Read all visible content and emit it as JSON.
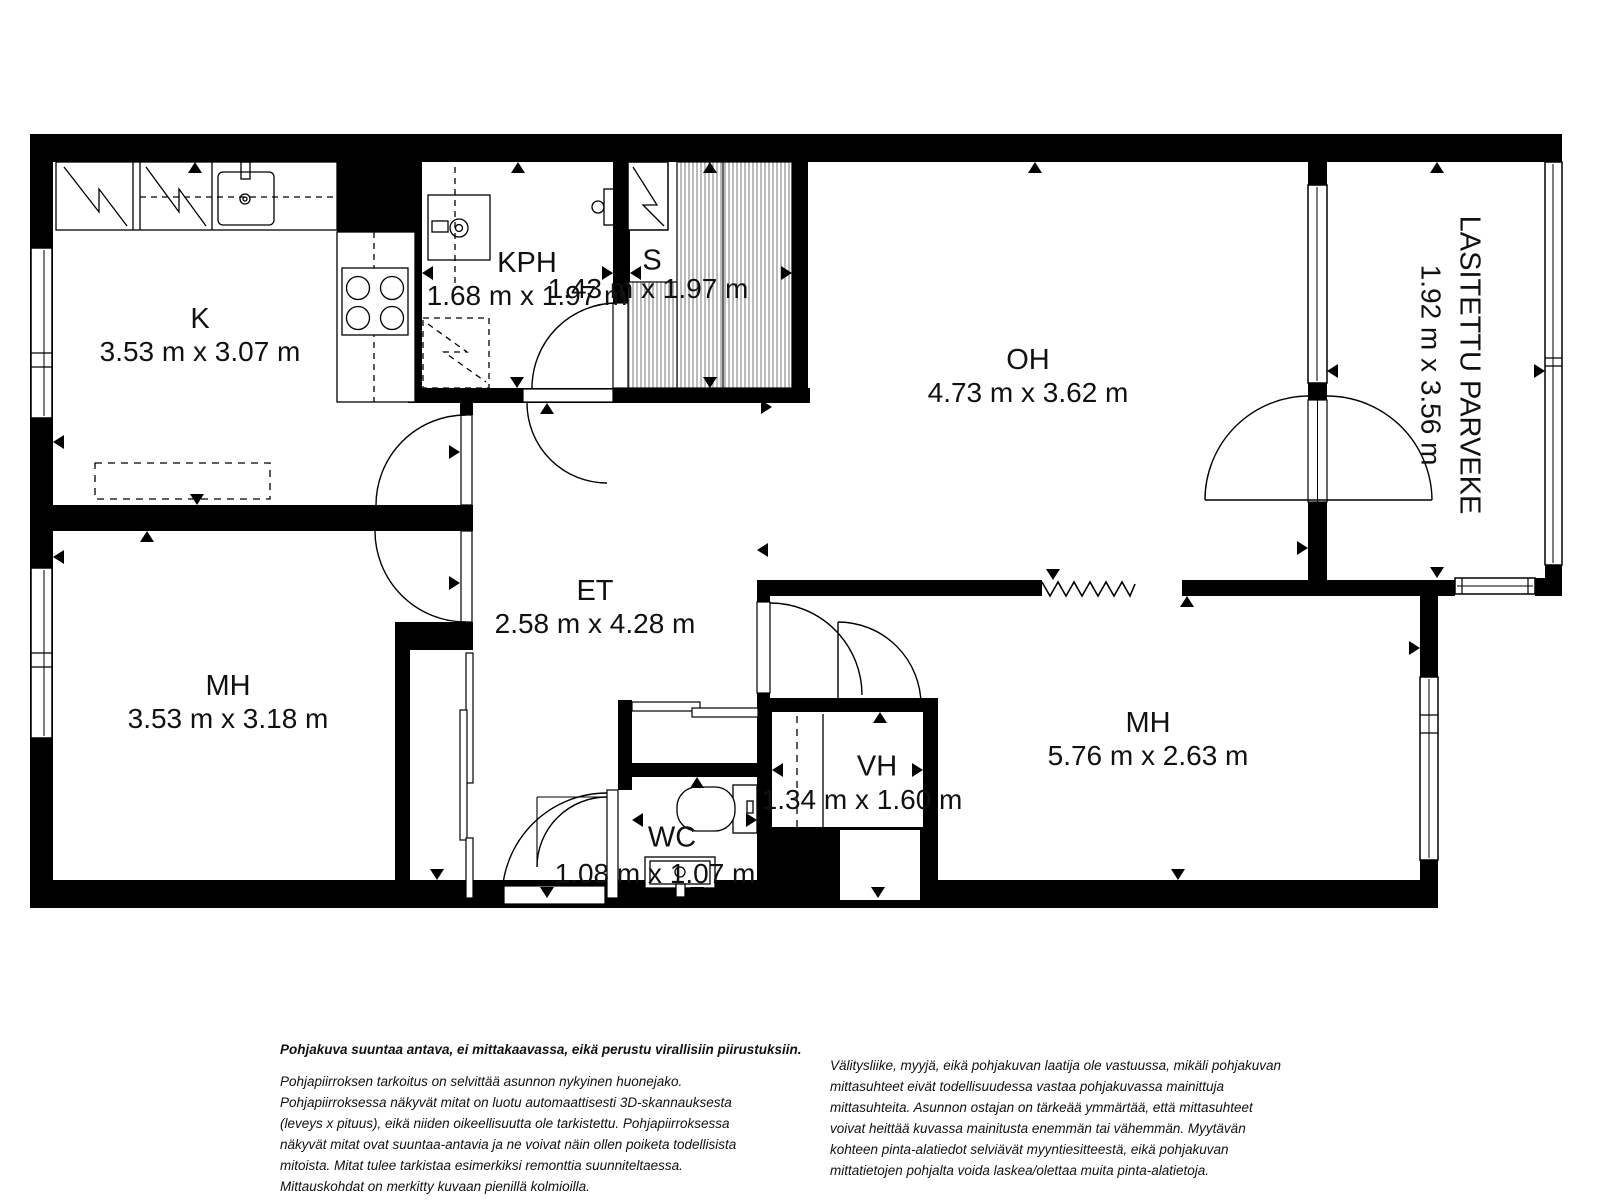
{
  "plan": {
    "rooms": [
      {
        "key": "k",
        "name": "K",
        "dims": "3.53 m x 3.07 m"
      },
      {
        "key": "kph",
        "name": "KPH",
        "dims": "1.68 m x 1.97 m"
      },
      {
        "key": "s",
        "name": "S",
        "dims": "1.43 m x 1.97 m"
      },
      {
        "key": "oh",
        "name": "OH",
        "dims": "4.73 m x 3.62 m"
      },
      {
        "key": "parveke",
        "name": "LASITETTU PARVEKE",
        "dims": "1.92 m x 3.56 m"
      },
      {
        "key": "mh1",
        "name": "MH",
        "dims": "3.53 m x 3.18 m"
      },
      {
        "key": "et",
        "name": "ET",
        "dims": "2.58 m x 4.28 m"
      },
      {
        "key": "vh",
        "name": "VH",
        "dims": "1.34 m x 1.60 m"
      },
      {
        "key": "wc",
        "name": "WC",
        "dims": "1.08 m x 1.07 m"
      },
      {
        "key": "mh2",
        "name": "MH",
        "dims": "5.76 m x 2.63 m"
      }
    ]
  },
  "footer": {
    "disclaimer_bold": "Pohjakuva suuntaa antava, ei mittakaavassa, eikä perustu virallisiin piirustuksiin.",
    "disclaimer_left": "Pohjapiirroksen tarkoitus on selvittää asunnon nykyinen huonejako. Pohjapiirroksessa näkyvät mitat on luotu automaattisesti 3D-skannauksesta (leveys x pituus), eikä niiden oikeellisuutta ole tarkistettu. Pohjapiirroksessa näkyvät mitat ovat suuntaa-antavia ja ne voivat näin ollen poiketa todellisista mitoista. Mitat tulee tarkistaa esimerkiksi remonttia suunniteltaessa. Mittauskohdat on merkitty kuvaan pienillä kolmioilla.",
    "disclaimer_right": "Välitysliike, myyjä, eikä pohjakuvan laatija ole vastuussa, mikäli pohjakuvan mittasuhteet eivät todellisuudessa vastaa pohjakuvassa mainittuja mittasuhteita. Asunnon ostajan on tärkeää ymmärtää, että mittasuhteet voivat heittää kuvassa mainitusta enemmän tai vähemmän. Myytävän kohteen pinta-alatiedot selviävät myyntiesitteestä, eikä pohjakuvan mittatietojen pohjalta voida laskea/olettaa muita pinta-alatietoja."
  },
  "colors": {
    "wall": "#000000",
    "background": "#ffffff",
    "hatch": "#555555",
    "text": "#111111"
  }
}
